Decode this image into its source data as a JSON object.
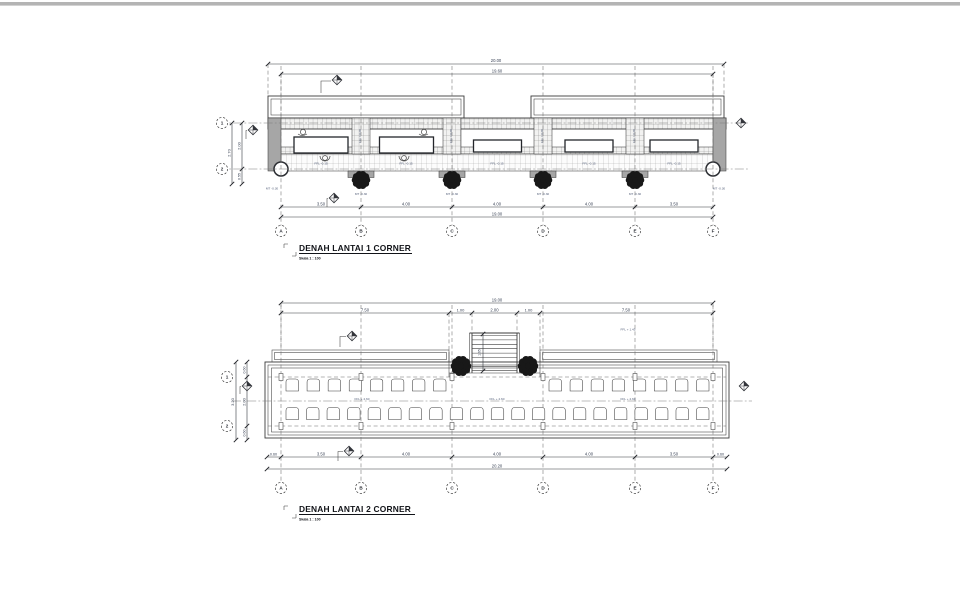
{
  "drawing": {
    "background": "#ffffff",
    "topbar_color": "#b4b4b4",
    "line_color": "#3c3c3c",
    "dim_text_color": "#3a4356",
    "label_text_color": "#55607a",
    "wall_fill": "#a6a6a6",
    "tree_color": "#181818"
  },
  "grid": {
    "letters": [
      "A",
      "B",
      "C",
      "D",
      "E",
      "F"
    ],
    "rows": [
      "1",
      "2"
    ]
  },
  "plan1": {
    "title": "DENAH LANTAI 1 CORNER",
    "scale_label": "Skala 1 : 100",
    "dim_total_top": "20.00",
    "dim_inner_top": "19.60",
    "dims_span": [
      "3.50",
      "4.00",
      "4.00",
      "4.00",
      "3.50"
    ],
    "dim_total_bottom": "19.00",
    "dim_left_outer": "2.70",
    "dim_left_upper": "2.00",
    "dim_left_lower": "0.55",
    "label_ground": "MT -0.30",
    "label_walkway": "FFL -0.15",
    "label_floor": "FFL ± 0.00"
  },
  "plan2": {
    "title": "DENAH LANTAI 2 CORNER",
    "scale_label": "Skala 1 : 100",
    "dim_total_top": "19.00",
    "dims_top": [
      "7.50",
      "1.00",
      "2.00",
      "1.00",
      "7.50"
    ],
    "dims_span": [
      "0.60",
      "3.50",
      "4.00",
      "4.00",
      "4.00",
      "3.50",
      "0.60"
    ],
    "dim_total_bottom": "20.20",
    "dim_left_outer": "3.20",
    "dims_left": [
      "0.60",
      "2.00",
      "0.60"
    ],
    "label_upper_landing": "FFL + 1.45",
    "label_floor": "FFL + 2.60",
    "label_stair_rise": "1.65"
  }
}
